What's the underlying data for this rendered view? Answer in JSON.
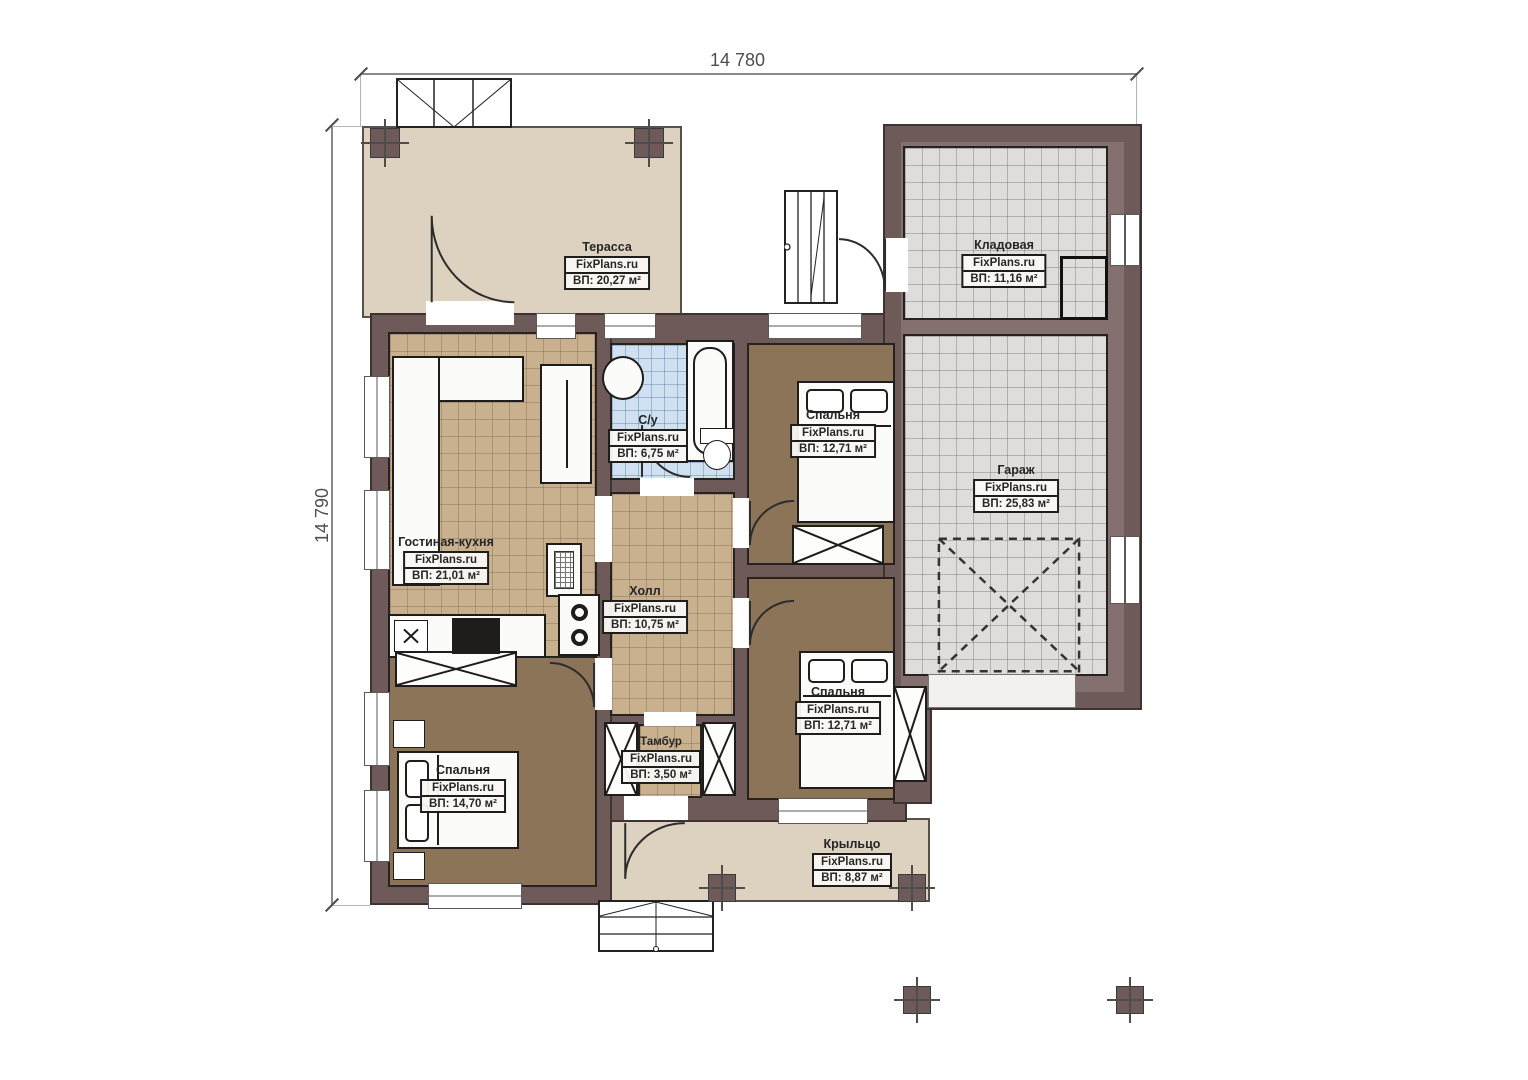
{
  "watermark": "FixPlans.ru",
  "dimensions": {
    "width_top": "14 780",
    "height_left": "14 790"
  },
  "rooms": [
    {
      "key": "terrace",
      "name": "Терасса",
      "area": "ВП: 20,27 м²"
    },
    {
      "key": "storage",
      "name": "Кладовая",
      "area": "ВП: 11,16 м²"
    },
    {
      "key": "bathroom",
      "name": "С/у",
      "area": "ВП: 6,75 м²"
    },
    {
      "key": "bedroom-top-right",
      "name": "Спальня",
      "area": "ВП: 12,71 м²"
    },
    {
      "key": "garage",
      "name": "Гараж",
      "area": "ВП: 25,83 м²"
    },
    {
      "key": "living-kitchen",
      "name": "Гостиная-кухня",
      "area": "ВП: 21,01 м²"
    },
    {
      "key": "hall",
      "name": "Холл",
      "area": "ВП: 10,75 м²"
    },
    {
      "key": "bedroom-bottom-right",
      "name": "Спальня",
      "area": "ВП: 12,71 м²"
    },
    {
      "key": "vestibule",
      "name": "Тамбур",
      "area": "ВП: 3,50 м²"
    },
    {
      "key": "bedroom-bottom-left",
      "name": "Спальня",
      "area": "ВП: 14,70 м²"
    },
    {
      "key": "porch",
      "name": "Крыльцо",
      "area": "ВП: 8,87 м²"
    }
  ],
  "colors": {
    "wall": "#6e5b59",
    "wall_light": "#84716f",
    "outline": "#3e3331",
    "terrace": "#ddd2c0",
    "tile_tan": "#c9b190",
    "tile_blue": "#cfe1f1",
    "tile_gray": "#dedddc",
    "floor_brown": "#8c7458",
    "fixture": "#fbfbfa"
  }
}
